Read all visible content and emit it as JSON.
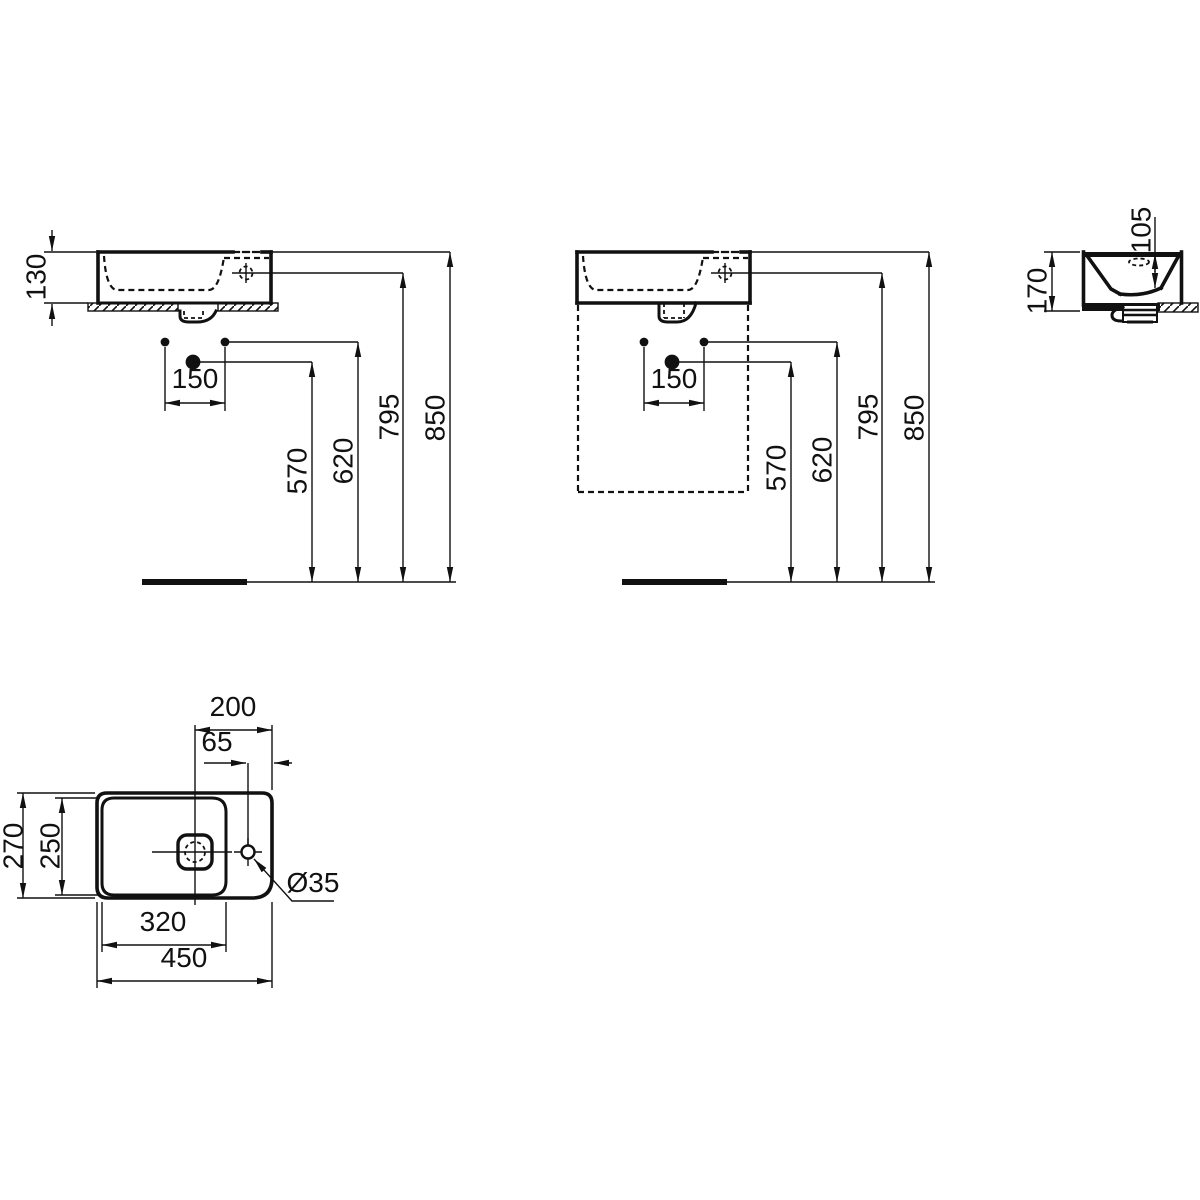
{
  "drawing": {
    "kind": "washbasin installation technical drawing",
    "colors": {
      "line": "#111111",
      "background": "#ffffff"
    },
    "views": {
      "front_wall_mounted": {
        "dim_basin_height": "130",
        "dim_hole_spacing": "150",
        "dim_drain_height": "570",
        "dim_fixing_height": "620",
        "dim_taphole_height": "795",
        "dim_rim_height": "850"
      },
      "front_with_furniture": {
        "dim_hole_spacing": "150",
        "dim_drain_height": "570",
        "dim_fixing_height": "620",
        "dim_taphole_height": "795",
        "dim_rim_height": "850"
      },
      "side": {
        "dim_bowl_depth": "105",
        "dim_total_height": "170"
      },
      "plan": {
        "dim_drain_to_edge": "200",
        "dim_taphole_to_edge": "65",
        "dim_total_depth": "270",
        "dim_bowl_depth": "250",
        "dim_bowl_width": "320",
        "dim_total_width": "450",
        "dim_taphole_diameter": "Ø35"
      }
    }
  }
}
